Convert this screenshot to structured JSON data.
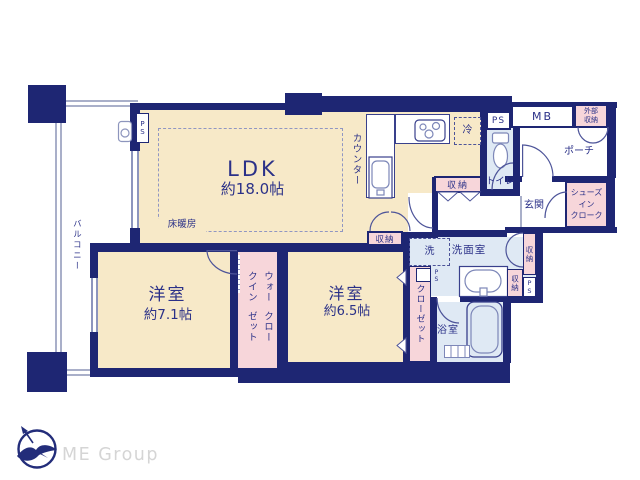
{
  "labels": {
    "storage": "収納",
    "ps": "PS"
  },
  "ldk": {
    "name": "LDK",
    "area": "約18.0帖",
    "floor_heating": "床暖房",
    "counter": "カウンター",
    "fridge": "冷"
  },
  "bedroom_left": {
    "name": "洋室",
    "area": "約7.1帖"
  },
  "bedroom_right": {
    "name": "洋室",
    "area": "約6.5帖"
  },
  "balcony": {
    "name": "バルコニー"
  },
  "wic": {
    "line1": "ウォークイン",
    "line2": "クローゼット"
  },
  "closet": {
    "name": "クローゼット"
  },
  "entrance": {
    "mb": "MB",
    "outdoor_storage_line1": "外部",
    "outdoor_storage_line2": "収納",
    "porch": "ポーチ",
    "genkan": "玄関",
    "sic_line1": "シューズ",
    "sic_line2": "イン",
    "sic_line3": "クローク",
    "toilet": "トイレ"
  },
  "sanitary": {
    "laundry": "洗",
    "washroom": "洗面室",
    "bath": "浴室"
  },
  "footer": {
    "brand": "ME Group"
  }
}
